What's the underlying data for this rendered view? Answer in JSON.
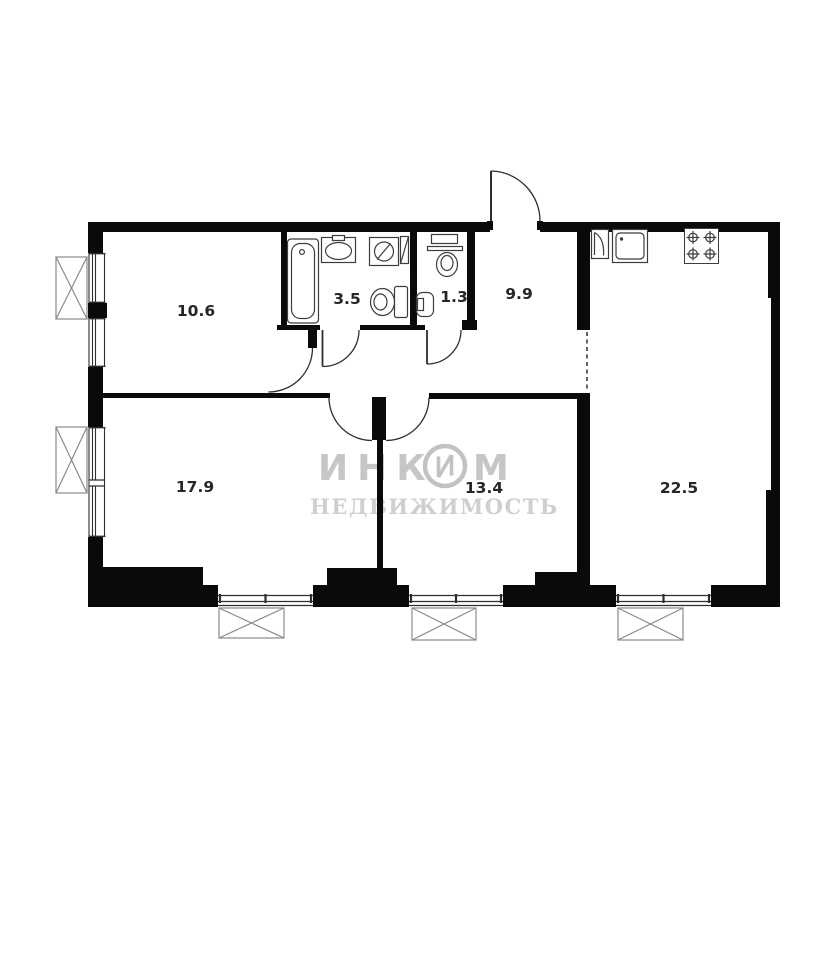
{
  "plan": {
    "type": "apartment-floor-plan",
    "rooms": [
      {
        "name": "room-top-left",
        "area": "10.6"
      },
      {
        "name": "bathroom",
        "area": "3.5"
      },
      {
        "name": "wc",
        "area": "1.3"
      },
      {
        "name": "hallway",
        "area": "9.9"
      },
      {
        "name": "room-bottom-left",
        "area": "17.9"
      },
      {
        "name": "room-bottom-middle",
        "area": "13.4"
      },
      {
        "name": "kitchen-living-room",
        "area": "22.5"
      }
    ],
    "watermark": {
      "brand_full": "ИНКОМ",
      "brand_part1": "ИНК",
      "brand_part2": "М",
      "tagline": "НЕДВИЖИМОСТЬ"
    },
    "fixtures": [
      "bathtub",
      "washbasin",
      "washing-machine",
      "vent-duct",
      "toilet",
      "wc-shelf-sink",
      "wc-toilet",
      "wc-corner-basin",
      "fridge",
      "kitchen-sink",
      "stove-4-burners"
    ],
    "colors": {
      "walls": "#0a0a0a",
      "lines": "#2e2e2e",
      "fixture_lines": "#3c3c3c",
      "xbox_lines": "#8a8a8a",
      "watermark": "#c6c6c6",
      "background": "#ffffff"
    }
  }
}
